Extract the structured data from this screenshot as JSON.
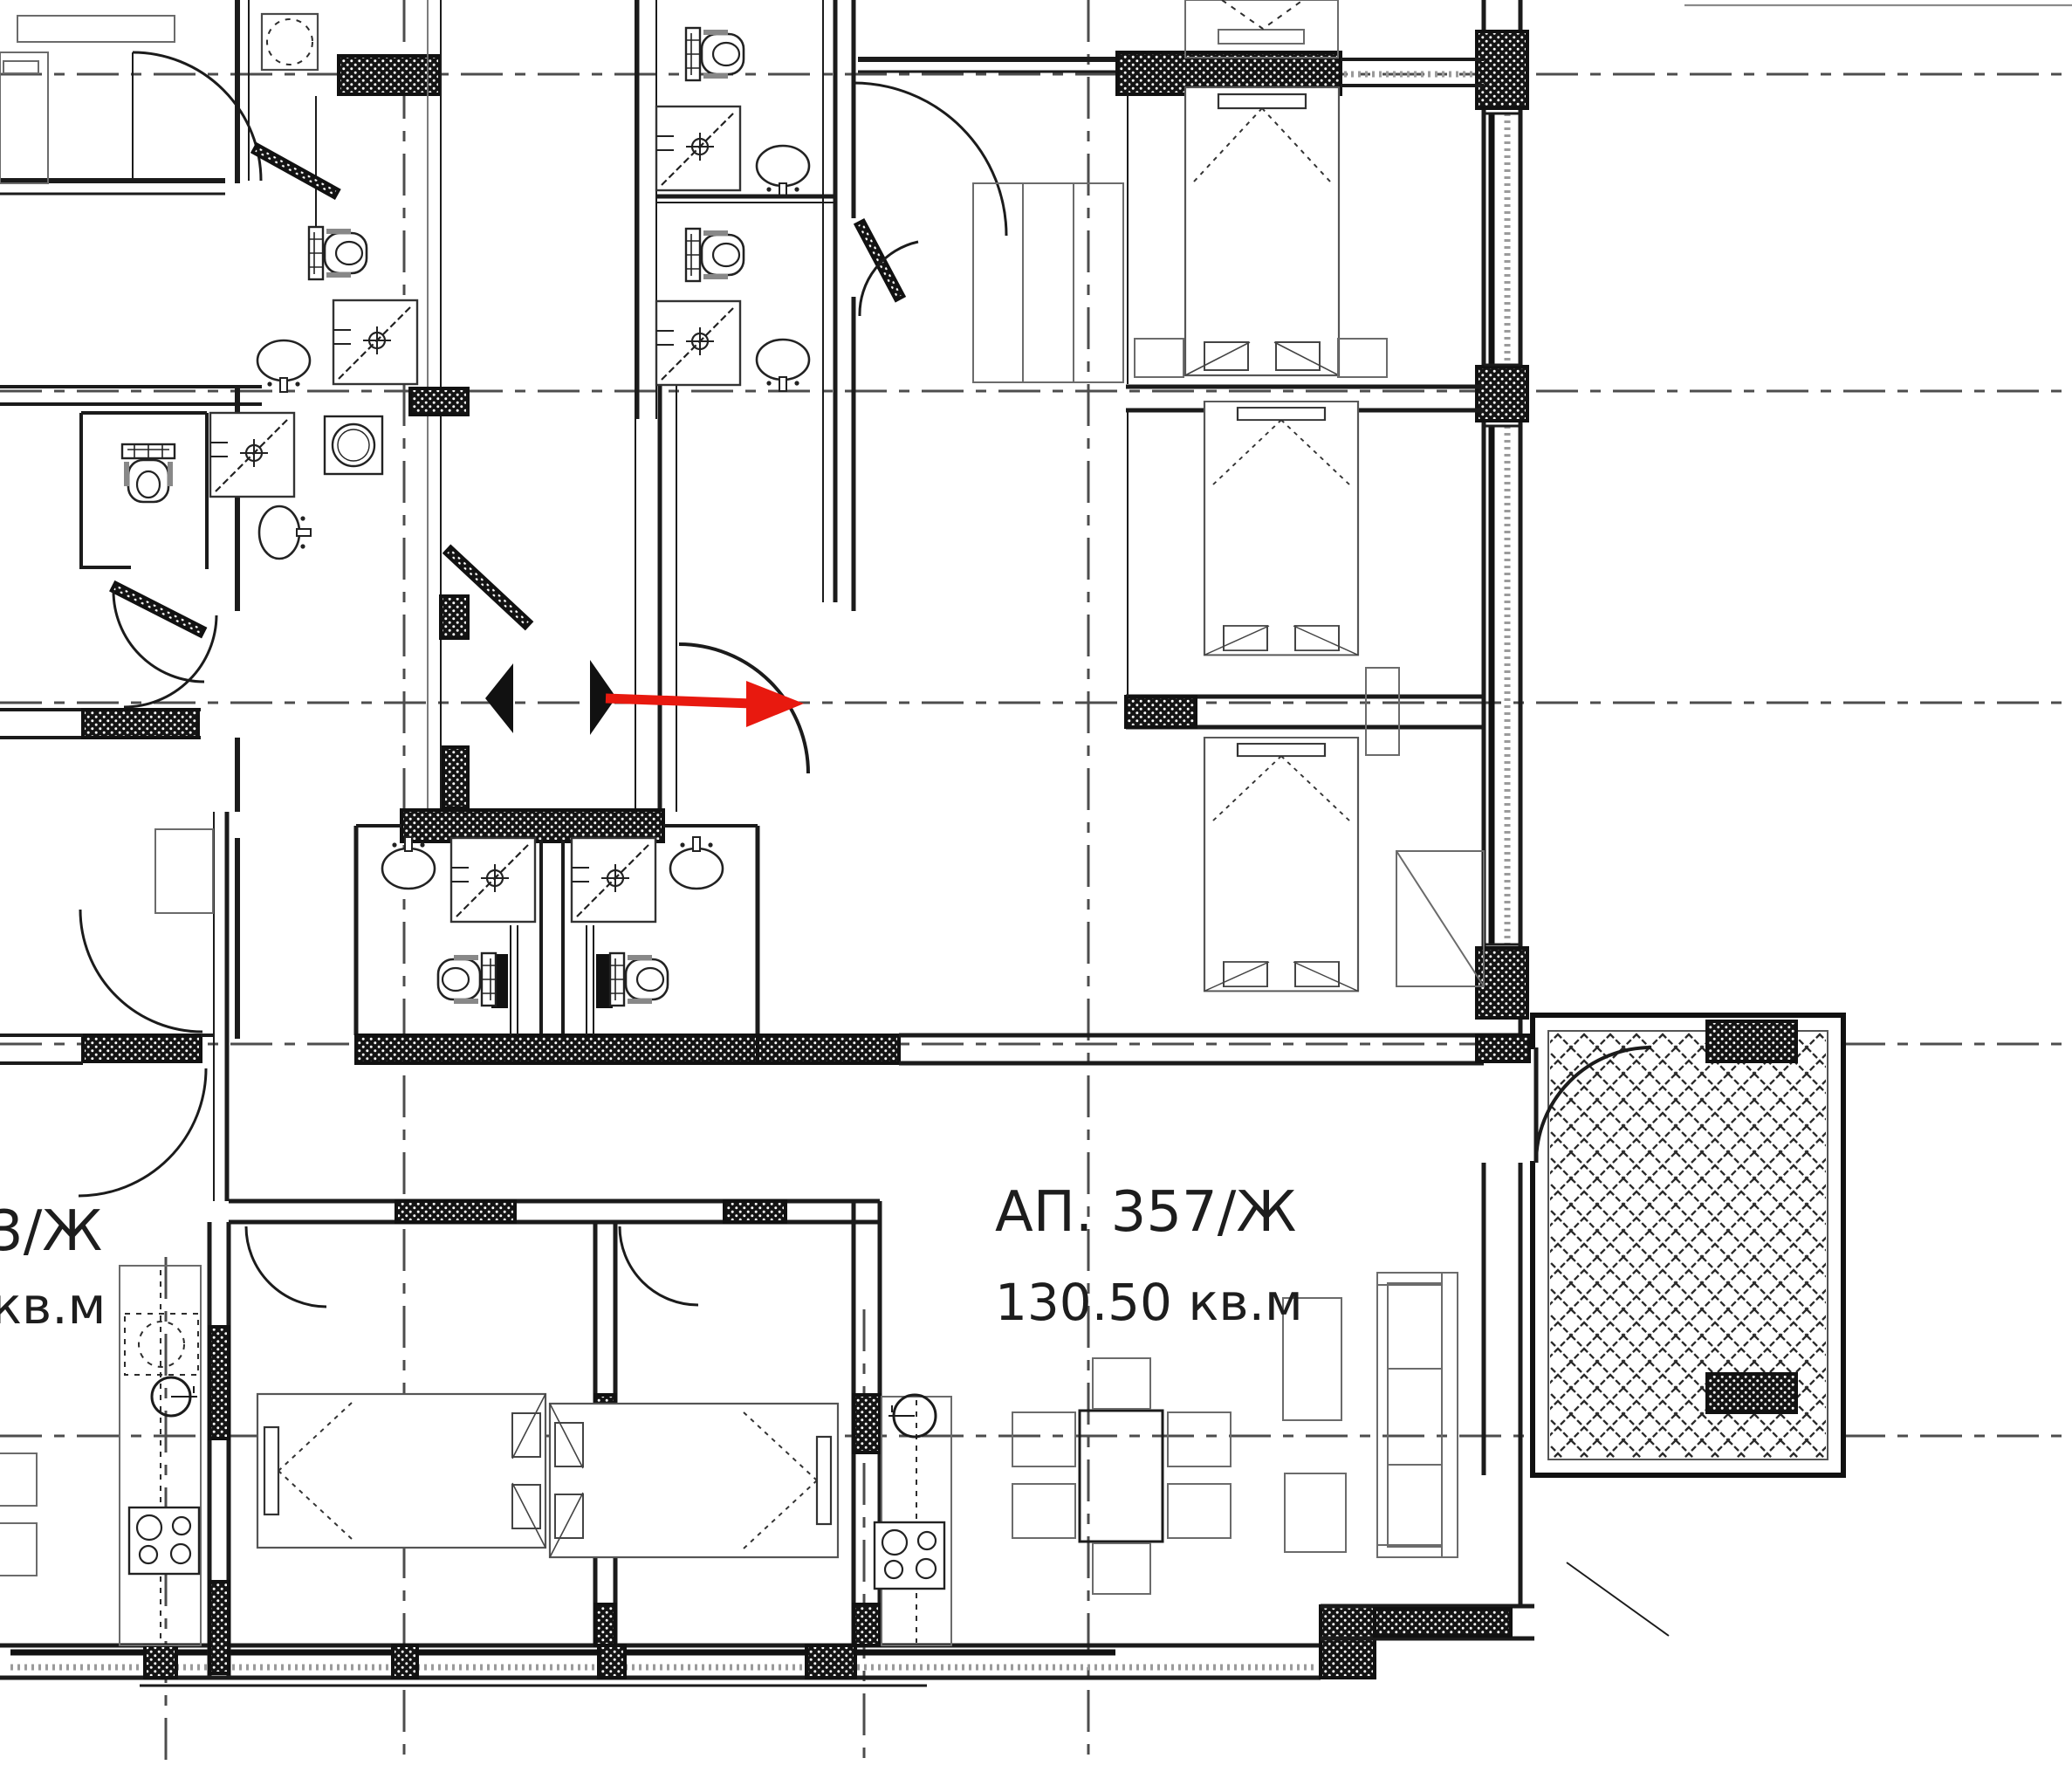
{
  "document": {
    "type": "architectural-floor-plan",
    "units": "кв.м"
  },
  "labels": {
    "apartment": {
      "id": "АП. 357/Ж",
      "area": "130.50 кв.м"
    },
    "partial_apartment": {
      "id": "3/Ж",
      "area": "кв.м"
    }
  },
  "annotations": {
    "red_arrow": "entry-direction-arrow",
    "door_triangles": "entrance-direction-markers"
  },
  "colors": {
    "line": "#1b1b1b",
    "gray": "#8a8a8a",
    "red": "#e8190f",
    "background": "#ffffff"
  }
}
